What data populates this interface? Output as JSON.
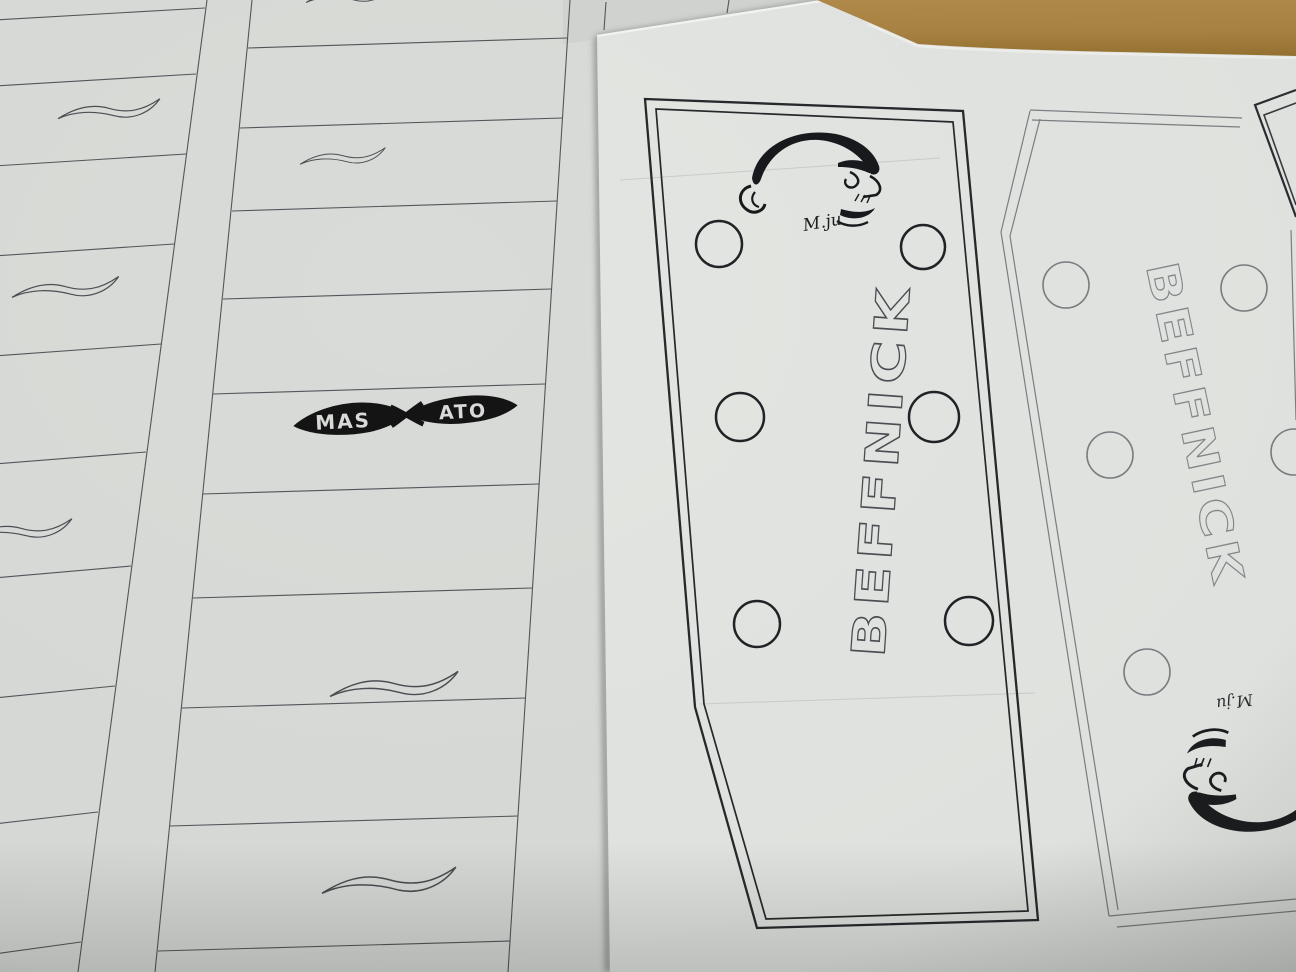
{
  "colors": {
    "table_brown": "#ab8545",
    "table_brown_dark": "#94702f",
    "paper_left": "#d9dbd8",
    "paper_right": "#e3e5e2",
    "paper_under": "#d2d4d2",
    "ink_dark": "#26282b",
    "ink_mid": "#4b4e52",
    "ink_light": "#7b7f82",
    "logo_black": "#141414"
  },
  "left_sheet": {
    "label": "fretboard-template-sheet",
    "fret_columns_visible": 2,
    "swoosh_inlays_visible": 7,
    "inlay_logo": {
      "left_word": "MAS",
      "right_word": "ATO"
    }
  },
  "right_sheet": {
    "label": "headstock-template-sheet",
    "headstock_primary": {
      "brand": "BEFFNICK",
      "signature": "M.ju",
      "tuner_holes": 6
    },
    "headstock_secondary": {
      "brand": "BEFFNICK",
      "signature": "M.ju",
      "tuner_holes_visible": 5
    }
  }
}
